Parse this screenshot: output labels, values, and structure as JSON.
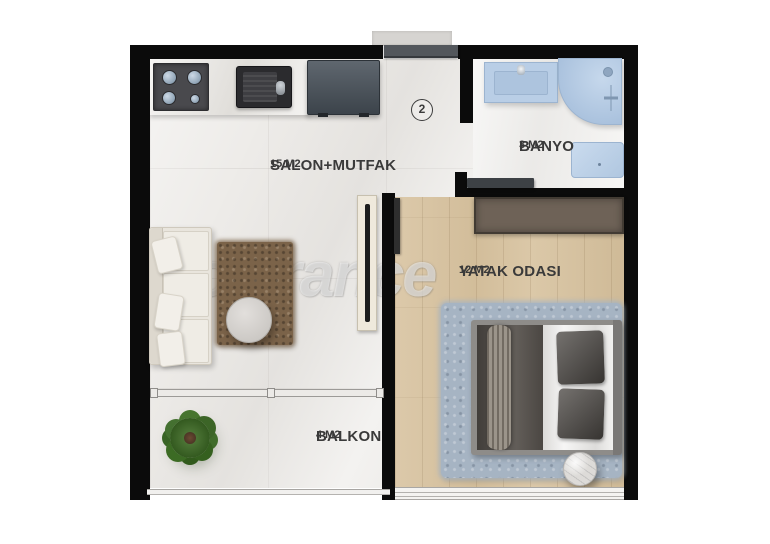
{
  "watermark": {
    "text": "Tolerance",
    "registered": "®"
  },
  "unit_number": "2",
  "rooms": [
    {
      "id": "salon-mutfak",
      "name": "SALON+MUTFAK",
      "area": "15 M2"
    },
    {
      "id": "banyo",
      "name": "BANYO",
      "area": "3 M2"
    },
    {
      "id": "yatak-odasi",
      "name": "YATAK ODASI",
      "area": "12 M2"
    },
    {
      "id": "balkon",
      "name": "BALKON",
      "area": "4 M2"
    }
  ],
  "colors": {
    "wall": "#0b0b0b",
    "marble_floor": "#edebe8",
    "wood_floor": "#d8c5a5",
    "fixture_blue": "#b9cee6",
    "wardrobe_brown": "#6e6257",
    "carpet_brown": "#7b6349",
    "rug_blue": "#a6b4c3",
    "label_text": "#3a3a3a"
  }
}
